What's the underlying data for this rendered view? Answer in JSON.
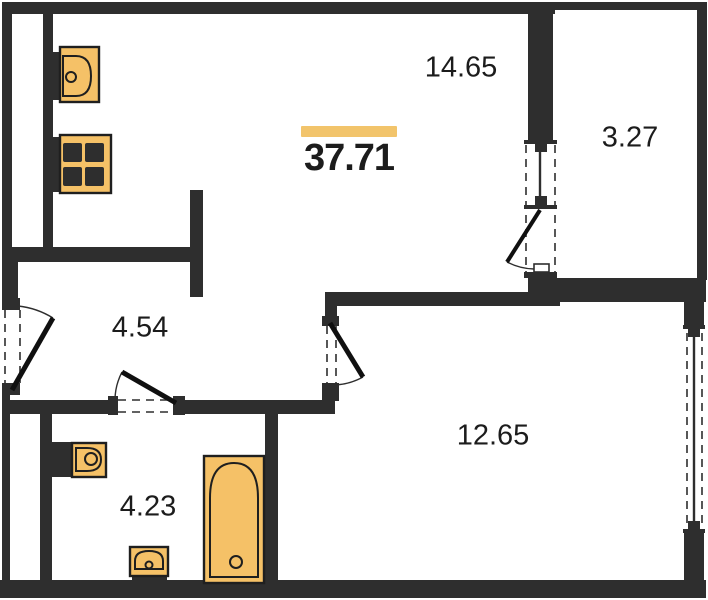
{
  "floorplan": {
    "total_area": "37.71",
    "rooms": {
      "living_kitchen": {
        "area": "14.65"
      },
      "balcony": {
        "area": "3.27"
      },
      "hallway": {
        "area": "4.54"
      },
      "bedroom": {
        "area": "12.65"
      },
      "bathroom": {
        "area": "4.23"
      }
    },
    "fixtures": [
      "kitchen-sink-icon",
      "stove-icon",
      "toilet-icon",
      "washbasin-icon",
      "bathtub-icon"
    ],
    "colors": {
      "wall": "#2e2e2e",
      "fixture_fill": "#f5c167",
      "fixture_stroke": "#1f1f1f",
      "accent_bar": "#f2c46b",
      "text": "#1c1c1c",
      "background": "#ffffff"
    }
  }
}
